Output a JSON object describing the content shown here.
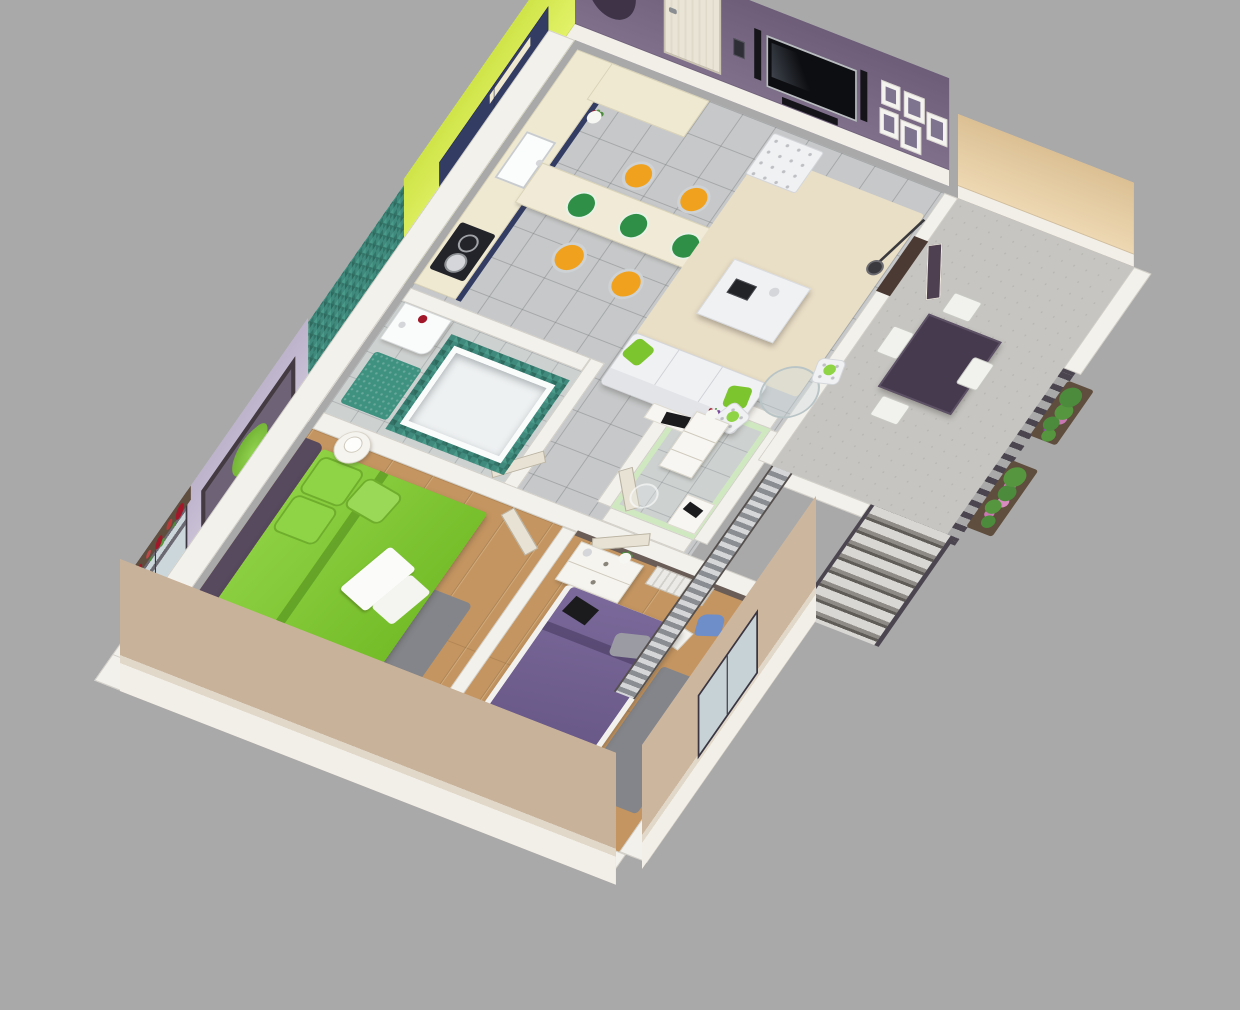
{
  "scene": {
    "type": "3d-isometric-floorplan-render",
    "subject": "Cutaway 3D render of a two-bedroom apartment with balcony",
    "background": "#a9a9a9",
    "visible_text": []
  },
  "palette": {
    "background": "#a9a9a9",
    "wall_purple": "#7a6a86",
    "arch_dark": "#3e3347",
    "wall_lime": "#d8ec55",
    "wall_lilac": "#c9c0d4",
    "wall_pale_green": "#cfe8c0",
    "wall_beige": "#e4cba4",
    "wall_white": "#f2efe9",
    "exterior_taupe": "#c9b29a",
    "partition_white": "#f3f1ec",
    "navy_cabinet": "#333c63",
    "counter_cream": "#efe9d2",
    "door_cream": "#e7e2d4",
    "door_dark": "#4e4050",
    "doorway_dark": "#4a3a33",
    "tv_black": "#0d0e11",
    "speaker_black": "#141419",
    "frame_inner": "#7e7490",
    "concrete": "#c6c5c1",
    "teal_mat": "#3f9180",
    "sofa_white": "#f0f1f3",
    "rug_beige": "#e9dec6",
    "rug_gray": "#83858a",
    "bed_green": "#7dc52f",
    "headboard_purple": "#57495e",
    "bed_purple": "#6f5e8b",
    "pillow_purple": "#6a5987",
    "mattress_white": "#f2f1ee",
    "stool_orange": "#f0a21e",
    "plate_green": "#2f8f46",
    "chrome": "#d4d6d9",
    "railing_dark": "#4b4550",
    "table_dark": "#463a4e",
    "chair_blue": "#6e8ec9",
    "radiator_white": "#eceae6",
    "plant_green": "#4c8a3c",
    "flower_pink": "#c978b4",
    "flower_red": "#a2182a",
    "glass": "#ccd7dc",
    "ledge_white": "#f7f6f2",
    "laptop_black": "#1b1b1e",
    "bag_gray": "#9b9ba3",
    "mirror_frame": "#443a42",
    "tub_white": "#eef1f2"
  },
  "rooms": [
    {
      "id": "kitchen",
      "wall": "wall_lime",
      "features": [
        "l-counter",
        "sink",
        "cooktop",
        "upper-cabinets",
        "breakfast-bar",
        "bar-stools",
        "fridge",
        "flower-vase"
      ]
    },
    {
      "id": "living-room",
      "wall": "wall_purple",
      "features": [
        "entry-door",
        "wall-tv",
        "speakers",
        "soundbar",
        "picture-frames",
        "intercom",
        "arch-niche",
        "sofa",
        "coffee-table",
        "ottoman",
        "glass-dining-table",
        "dining-chairs",
        "floor-lamp",
        "beige-rug"
      ]
    },
    {
      "id": "bathroom",
      "wall": "mosaic-teal",
      "features": [
        "bathtub",
        "wall-sink",
        "bath-mat"
      ]
    },
    {
      "id": "wc-room",
      "wall": "wall_pale_green",
      "features": [
        "storage-cabinet",
        "flower-vase",
        "ghost-chair",
        "desk-ledge"
      ]
    },
    {
      "id": "hallway",
      "features": [
        "open-doors"
      ]
    },
    {
      "id": "bedroom-1",
      "wall": "wall_lilac",
      "features": [
        "green-double-bed",
        "purple-headboard",
        "wall-mirror",
        "round-nightstand",
        "table-lamp",
        "gray-rug",
        "potted-plant",
        "french-window",
        "flower-box"
      ]
    },
    {
      "id": "bedroom-2",
      "features": [
        "purple-double-bed",
        "nightstand-dresser",
        "radiator",
        "blue-desk-chair",
        "white-stool",
        "gray-rug",
        "floor-lamp",
        "window-plants"
      ]
    },
    {
      "id": "balcony",
      "wall": "wall_beige",
      "features": [
        "dark-dining-table",
        "four-white-chairs",
        "slat-railing",
        "flower-boxes",
        "exterior-stairs",
        "metal-stair-strip"
      ]
    }
  ]
}
